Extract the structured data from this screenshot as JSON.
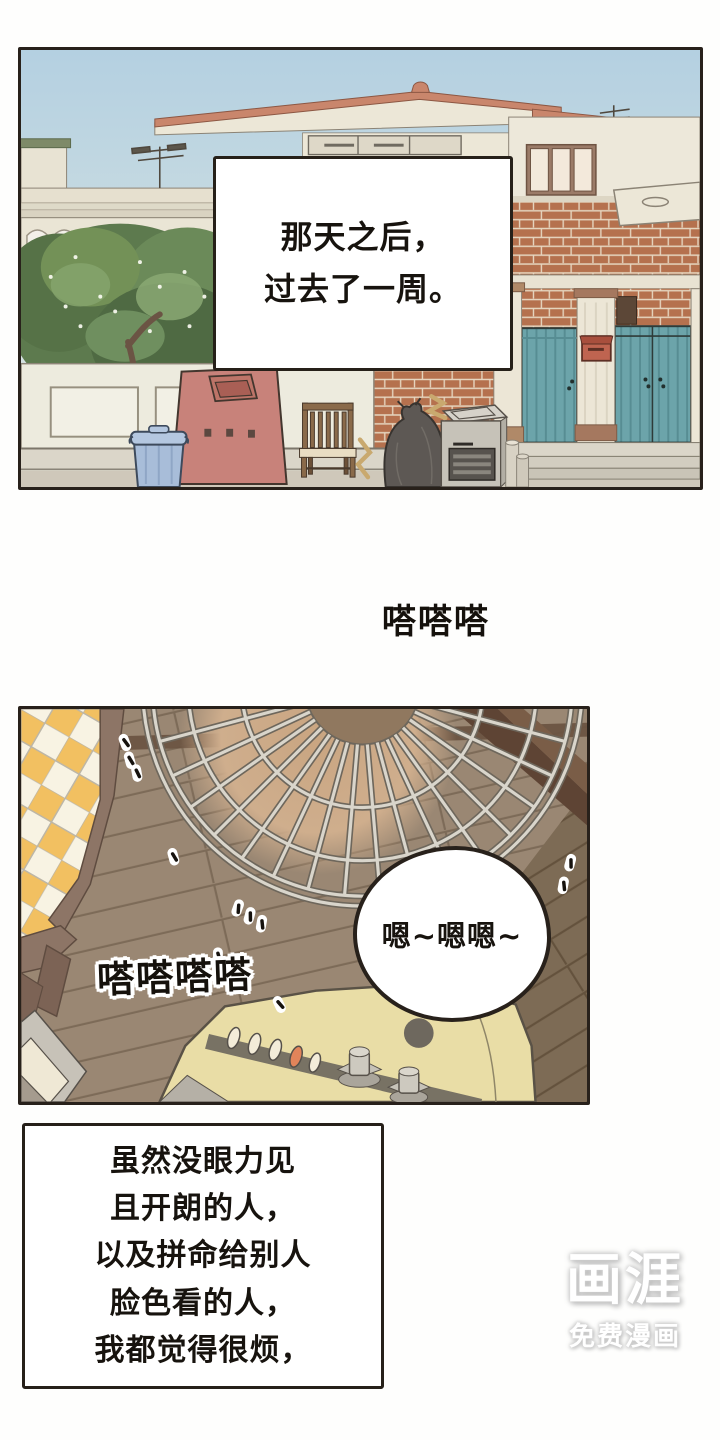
{
  "comic": {
    "panel1_caption": {
      "lines": [
        "那天之后，",
        "过去了一周。"
      ]
    },
    "sfx_tapping_small": "嗒嗒嗒",
    "panel2": {
      "speech_bubble": "嗯~嗯嗯~",
      "sfx_tapping": "嗒嗒嗒嗒"
    },
    "narration_box": {
      "lines": [
        "虽然没眼力见",
        "且开朗的人，",
        "以及拼命给别人",
        "脸色看的人，",
        "我都觉得很烦，"
      ]
    },
    "watermark": {
      "logo": "画涯",
      "tagline": "免费漫画"
    }
  },
  "colors": {
    "panel_border": "#28211b",
    "sky_top": "#b4d0e1",
    "sky_bottom": "#e3eae2",
    "tree_green": "#5d7a4e",
    "brick": "#b5714e",
    "gate_teal": "#6ca4aa",
    "donation_bin_red": "#c8827a",
    "trash_bin_blue": "#a8bdd9",
    "fan_body_cream": "#e9dda6",
    "floor_wood": "#9a8773",
    "blanket_yellow": "#f2c061"
  }
}
